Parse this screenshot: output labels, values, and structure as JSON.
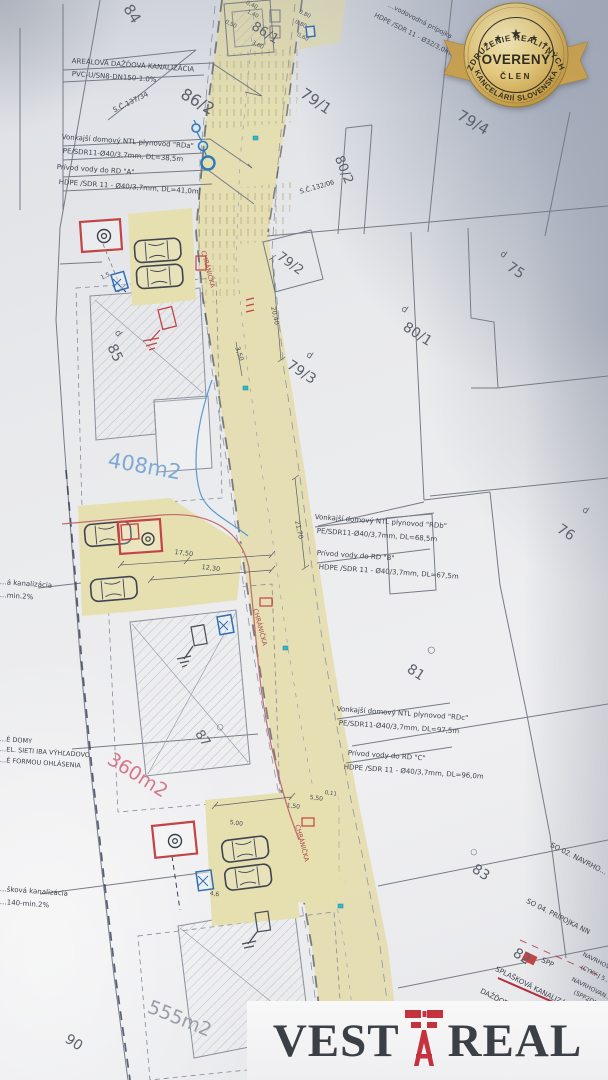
{
  "badge": {
    "arc_top": "ZDRUŽENIE REALITNÝCH",
    "title": "OVERENÝ",
    "subtitle": "ČLEN",
    "arc_bottom": "KANCELÁRIÍ SLOVENSKA",
    "stars": "★"
  },
  "logo": {
    "left": "VEST",
    "right": "REAL",
    "icon": "derrick-icon"
  },
  "parcels": [
    {
      "label": "84"
    },
    {
      "label": "86/1"
    },
    {
      "label": "86/2"
    },
    {
      "label": "79/1"
    },
    {
      "label": "79/4"
    },
    {
      "label": "80/2"
    },
    {
      "label": "79/2"
    },
    {
      "label": "75",
      "marker": "d"
    },
    {
      "label": "80/1",
      "marker": "d"
    },
    {
      "label": "79/3",
      "marker": "d"
    },
    {
      "label": "85",
      "marker": "d"
    },
    {
      "label": "76",
      "marker": "d"
    },
    {
      "label": "81",
      "marker": "○"
    },
    {
      "label": "87",
      "marker": "○"
    },
    {
      "label": "83",
      "marker": "○"
    },
    {
      "label": "82"
    },
    {
      "label": "90"
    }
  ],
  "areas": {
    "a1": "408m2",
    "a2": "360m2",
    "a3": "555m2"
  },
  "annotations": {
    "a1l1": "AREÁLOVÁ DAŽĎOVÁ KANALIZÁCIA",
    "a1l2": "PVC-U/SN8-DN150-1.0%",
    "sc1": "S.Č.137/34",
    "sc2": "S.Č.132/06",
    "a2l1": "Vonkajší domový NTL plynovod \"RDa\"",
    "a2l2": "PE/SDR11-Ø40/3,7mm, DL=38,5m",
    "a3l1": "Prívod vody do RD \"A\"",
    "a3l2": "HDPE /SDR 11 - Ø40/3,7mm, DL=41,0m",
    "a4l1": "…vodovodná prípojka",
    "a4l2": "HDPE /SDR 11 - Ø32/3,0mm, DĽ=2,0m",
    "a5l1": "Vonkajší domový NTL plynovod \"RDb\"",
    "a5l2": "PE/SDR11-Ø40/3,7mm, DL=68,5m",
    "a6l1": "Prívod vody do RD \"B\"",
    "a6l2": "HDPE /SDR 11 - Ø40/3,7mm, DL=67,5m",
    "a7l1": "Vonkajší domový NTL plynovod \"RDc\"",
    "a7l2": "PE/SDR11-Ø40/3,7mm, DL=97,5m",
    "a8l1": "Prívod vody do RD \"C\"",
    "a8l2": "HDPE /SDR 11 - Ø40/3,7mm, DL=96,0m"
  },
  "edge_labels": {
    "e1l1": "…á kanalizácia",
    "e1l2": "…min.2%",
    "e2l1": "…É DOMY",
    "e2l2": "…EL. SIETI IBA VÝHĽADOVO",
    "e2l3": "…É FORMOU OHLÁSENIA",
    "e3l1": "…šková kanalizácia",
    "e3l2": "…140-min.2%"
  },
  "legend": {
    "l1": "SO 02. NAVRHO…",
    "l2": "SO 04. PRÍPOJKA NN",
    "l3": "SPP",
    "l4": "SPLAŠKOVÁ KANALIZÁC…",
    "l5": "DAŽĎOVÁ KANALIZÁC…",
    "r1": "NAVRHOVA…",
    "r2": "(CYKY-J 5…",
    "r3": "NAVRHOVAN…",
    "r4": "(SPP2DN…",
    "r5": "SPLAŠKOVÁ KAN…",
    "r6": "PVC-…"
  },
  "road": {
    "chranicka": "CHRÁNIČKA"
  },
  "dims": {
    "d1": "3,50",
    "d2": "17,50",
    "d3": "12,30",
    "d4": "20,40",
    "d5": "21,70",
    "d6": "1,50",
    "d7": "5,00",
    "d8": "5,50",
    "d9": "0,11",
    "t1": "0,40",
    "t2": "1,40",
    "t3": "0,50",
    "t4": "0,80",
    "t5": "0,80",
    "t6": "0,60",
    "t7": "3,00",
    "s1": "1,5",
    "s2": "4,6"
  },
  "colors": {
    "road_beige": "#e4ddad",
    "accent_red": "#c24444",
    "accent_blue": "#2f6fb2",
    "area_blue": "#7fa9d4",
    "area_pink": "#d4798b",
    "badge_gold": "#d9b560",
    "logo_red": "#c4323e"
  }
}
